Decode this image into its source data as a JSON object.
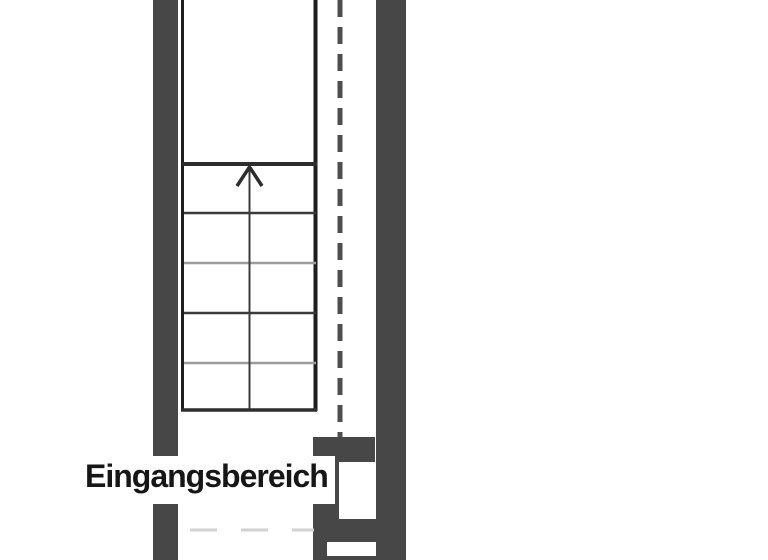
{
  "plan": {
    "label": "Eingangsbereich",
    "stairs": {
      "direction_arrow": "up",
      "tread_lines": 6
    },
    "colors": {
      "background": "#ffffff",
      "wall_fill": "#474747",
      "stair_outline": "#1e1e1e",
      "tread_dark": "#2d2d2d",
      "tread_mid": "#3a3a3a",
      "tread_light": "#9c9c9c",
      "walk_line": "#3c3c3c",
      "overhead_dash": "#4e4e4e",
      "faint_dash": "#d2d2d2",
      "label_text": "#161616"
    }
  }
}
